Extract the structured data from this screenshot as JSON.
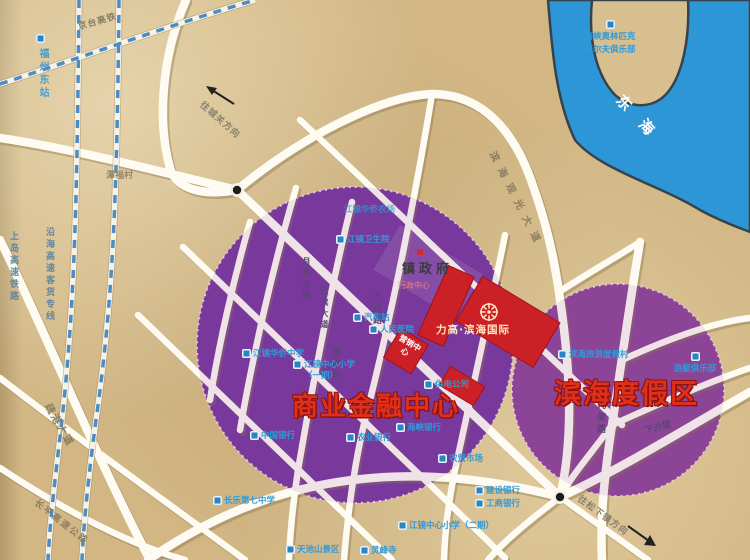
{
  "map": {
    "sea": "东海",
    "zones": {
      "commercial": "商业金融中心",
      "resort": "滨海度假区"
    },
    "project": {
      "name": "力高·滨海国际",
      "sales_center": "营销中心"
    },
    "gov": {
      "name": "镇政府",
      "sub": "行政中心"
    },
    "village": {
      "tanfu": "潭福村"
    },
    "rail": {
      "jingtai": "京台高铁",
      "station": "福州东站",
      "shangdao": "上岛高速铁路",
      "yanhai": "沿海高速客货专线"
    },
    "roads": {
      "shugang": "疏港大道",
      "changping": "长平高速公路",
      "binhai": "滨海观光大道",
      "yueliang": "月亮北路",
      "jiangbin": "江滨大道",
      "fangxing": "方兴路",
      "jingcheng": "镜城路",
      "jiushi": "九使路",
      "xiasha": "下沙堤"
    },
    "directions": {
      "chengguan": "往城关方向",
      "songxia": "往松下镇方向"
    },
    "pois": {
      "golf1": "海峡奥林匹克",
      "golf2": "高尔夫俱乐部",
      "qiaochang": "江镜华侨农场",
      "weishengyuan": "江镜卫生院",
      "huaqiao_zhongxue": "江镜华侨中学",
      "xiaoxue1": "江镜中心小学",
      "xiaoxue1_phase": "（一期）",
      "qichezhan": "汽车站",
      "renmin_yiyuan": "人民医院",
      "gongdian": "供电公司",
      "zhongguo_yinhang": "中国银行",
      "nongye_yinhang": "农业银行",
      "haixia_yinhang": "海峡银行",
      "nongmao": "农贸市场",
      "qizhong": "长乐第七中学",
      "xiaoxue2": "江镜中心小学（二期）",
      "tianchi": "天池山景区",
      "lingfeng": "灵峰寺",
      "jianshe_yinhang": "建设银行",
      "gongshang_yinhang": "工商银行",
      "dujiacun": "滨海旅游度假村",
      "youting": "游艇俱乐部"
    },
    "colors": {
      "land": "#d2b785",
      "water": "#2d96d7",
      "zone_left": "#76389a",
      "zone_right": "#8a4494",
      "road": "#ffffff",
      "accent_red": "#cc2027",
      "poi_blue": "#2f9ad8"
    }
  }
}
